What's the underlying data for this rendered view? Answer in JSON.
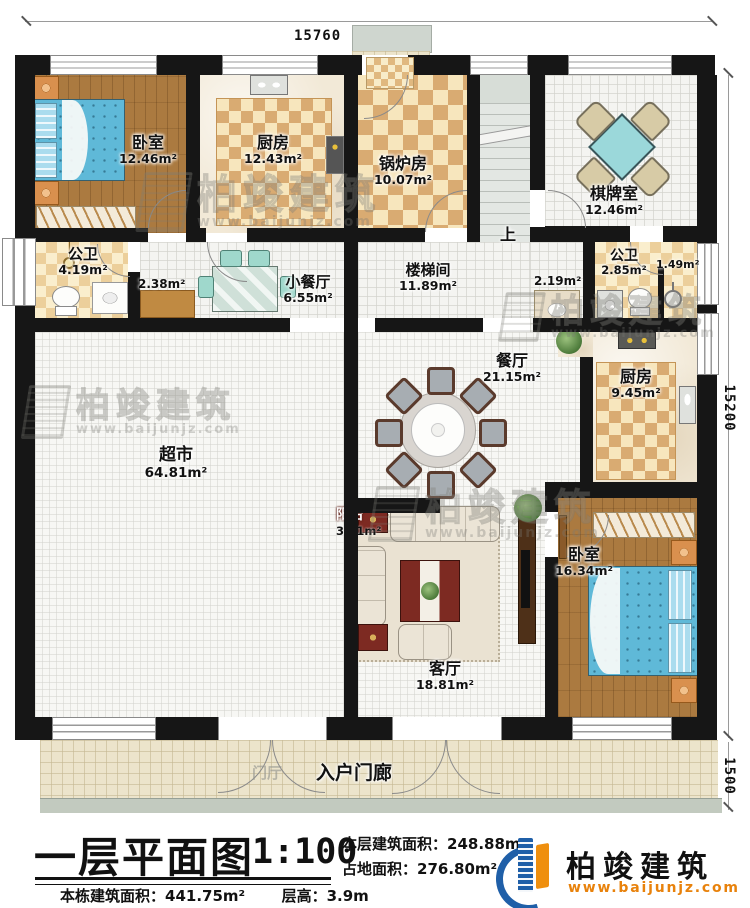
{
  "plan": {
    "dim_top": "15760",
    "dim_right": "15200",
    "dim_porch": "1500",
    "stairs_up": "上",
    "rooms": {
      "bedroom1": {
        "name": "卧室",
        "area": "12.46m²"
      },
      "kitchen1": {
        "name": "厨房",
        "area": "12.43m²"
      },
      "boiler": {
        "name": "锅炉房",
        "area": "10.07m²"
      },
      "chess": {
        "name": "棋牌室",
        "area": "12.46m²"
      },
      "bath_left": {
        "name": "公卫",
        "area": "4.19m²"
      },
      "closet": {
        "area": "2.38m²"
      },
      "small_dining": {
        "name": "小餐厅",
        "area": "6.55m²"
      },
      "stairwell": {
        "name": "楼梯间",
        "area": "11.89m²"
      },
      "vanity": {
        "area": "2.19m²"
      },
      "bath_right": {
        "name": "公卫",
        "area": "2.85m²"
      },
      "shower": {
        "area": "1.49m²"
      },
      "dining": {
        "name": "餐厅",
        "area": "21.15m²"
      },
      "kitchen2": {
        "name": "厨房",
        "area": "9.45m²"
      },
      "market": {
        "name": "超市",
        "area": "64.81m²"
      },
      "living": {
        "name": "客厅",
        "area": "18.81m²"
      },
      "balcony": {
        "name": "阳台",
        "area": "3.71m²"
      },
      "bedroom2": {
        "name": "卧室",
        "area": "16.34m²"
      },
      "porch": {
        "name": "入户门廊"
      },
      "foyer": {
        "name": "门厅"
      }
    }
  },
  "watermark": {
    "brand": "柏竣建筑",
    "url": "www.baijunjz.com"
  },
  "footer": {
    "title": "一层平面图",
    "scale": "1:100",
    "floor_area_label": "本层建筑面积：",
    "floor_area": "248.88m²",
    "land_area_label": "占地面积：",
    "land_area": "276.80m²",
    "total_area_label": "本栋建筑面积：",
    "total_area": "441.75m²",
    "storey_label": "层高：",
    "storey": "3.9m",
    "brand": "柏竣建筑",
    "brand_url": "www.baijunjz.com",
    "brand_blue": "#1f5fa8",
    "brand_orange": "#ef8f0e"
  }
}
